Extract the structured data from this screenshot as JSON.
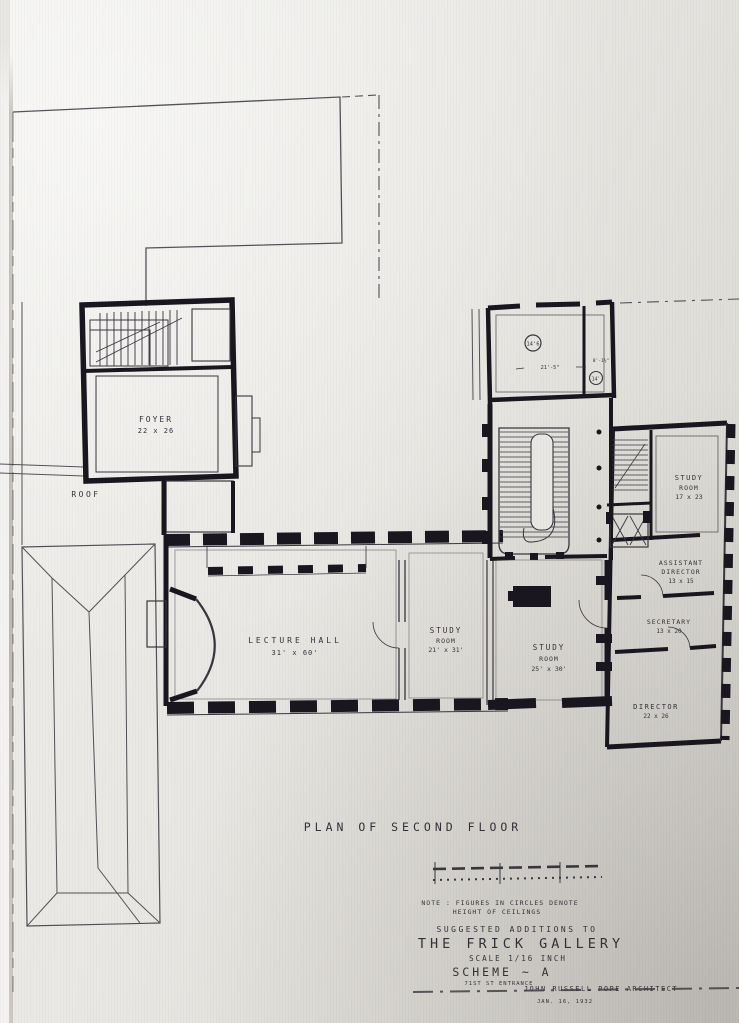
{
  "photo": {
    "paper_color": "#e9e7e3",
    "ink_color": "#26232b"
  },
  "plan": {
    "rooms": [
      {
        "id": "foyer",
        "label1": "FOYER",
        "label2": "22 x 26"
      },
      {
        "id": "roof",
        "label1": "ROOF"
      },
      {
        "id": "lecture-hall",
        "label1": "LECTURE HALL",
        "label2": "31' x 60'"
      },
      {
        "id": "study-room-west",
        "label1": "STUDY",
        "label2": "ROOM",
        "label3": "21' x 31'"
      },
      {
        "id": "study-room-center",
        "label1": "STUDY",
        "label2": "ROOM",
        "label3": "25' x 30'"
      },
      {
        "id": "study-room-east",
        "label1": "STUDY",
        "label2": "ROOM",
        "label3": "17 x 23"
      },
      {
        "id": "assistant-director",
        "label1": "ASSISTANT",
        "label2": "DIRECTOR",
        "label3": "13 x 15"
      },
      {
        "id": "secretary",
        "label1": "SECRETARY",
        "label2": "13 x 20"
      },
      {
        "id": "director",
        "label1": "DIRECTOR",
        "label2": "22 x 26"
      }
    ],
    "annotations": {
      "ceiling_height_1": "14'6",
      "ceiling_height_2": "14'",
      "dimension_1": "21'-5\"",
      "dimension_2": "8'-1½\""
    }
  },
  "title_block": {
    "plan_title": "PLAN OF SECOND FLOOR",
    "note_line1": "NOTE : FIGURES IN CIRCLES DENOTE",
    "note_line2": "HEIGHT OF CEILINGS",
    "suggested": "SUGGESTED ADDITIONS TO",
    "project_name": "THE FRICK GALLERY",
    "scale_note": "SCALE 1/16 INCH",
    "scheme": "SCHEME ~ A",
    "entrance_note": "71ST ST ENTRANCE",
    "architect": "JOHN RUSSELL POPE ARCHITECT",
    "date": "JAN. 16, 1932"
  }
}
